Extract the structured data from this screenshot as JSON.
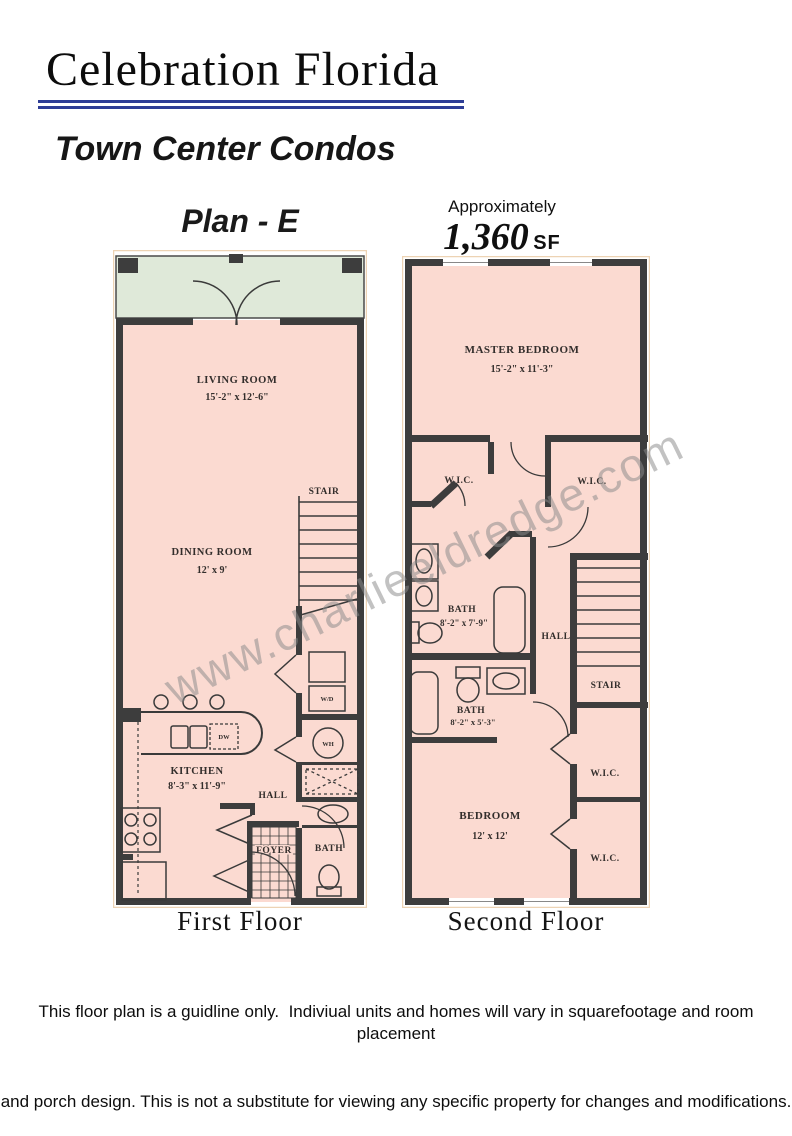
{
  "header": {
    "title": "Celebration Florida",
    "subtitle": "Town Center Condos"
  },
  "plan": {
    "name": "Plan - E",
    "approx_label": "Approximately",
    "area_value": "1,360",
    "area_unit": "SF"
  },
  "first_floor": {
    "caption": "First Floor",
    "living_room": {
      "name": "LIVING ROOM",
      "dims": "15'-2\" x 12'-6\""
    },
    "dining_room": {
      "name": "DINING ROOM",
      "dims": "12' x 9'"
    },
    "kitchen": {
      "name": "KITCHEN",
      "dims": "8'-3\" x 11'-9\""
    },
    "stair": "STAIR",
    "hall": "HALL",
    "foyer": "FOYER",
    "bath": "BATH",
    "washer_dryer": "W/D",
    "water_heater": "WH",
    "dishwasher": "DW"
  },
  "second_floor": {
    "caption": "Second Floor",
    "master_bedroom": {
      "name": "MASTER BEDROOM",
      "dims": "15'-2\" x 11'-3\""
    },
    "bath_upper": {
      "name": "BATH",
      "dims": "8'-2\" x 7'-9\""
    },
    "bath_lower": {
      "name": "BATH",
      "dims": "8'-2\" x 5'-3\""
    },
    "bedroom": {
      "name": "BEDROOM",
      "dims": "12' x 12'"
    },
    "wic": "W.I.C.",
    "hall": "HALL",
    "stair": "STAIR"
  },
  "watermark": "www.charlieeldredge.com",
  "disclaimer": {
    "line1": "This floor plan is a guidline only.  Indiviual units and homes will vary in squarefootage and room placement",
    "line2": "and porch design. This is not a substitute for viewing any specific property for changes and modifications."
  },
  "colors": {
    "accent_rule": "#2e3d96",
    "floor_fill": "#fbdad1",
    "porch_fill": "#dfe9d9",
    "wall": "#3d3d3d",
    "watermark_gray": "#8b8b8b"
  }
}
